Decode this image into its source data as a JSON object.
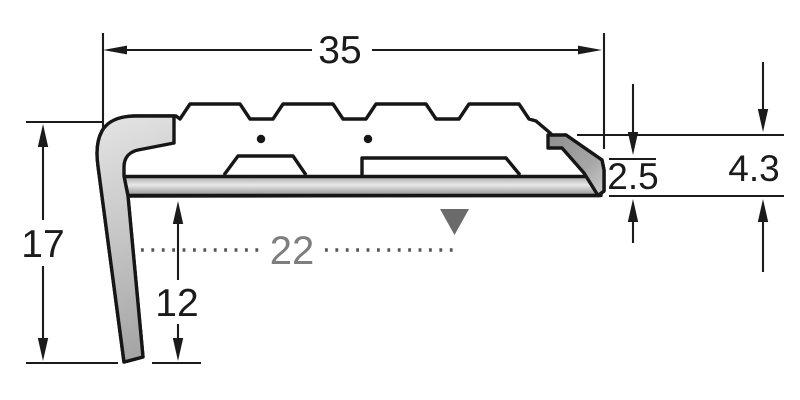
{
  "diagram": {
    "type": "technical-dimension-drawing",
    "subject": "stair-nosing-profile-cross-section",
    "dimensions": {
      "overall_width": "35",
      "front_height": "17",
      "tread_reference": "22",
      "leg_depth": "12",
      "back_height": "4.3",
      "edge_thickness": "2.5"
    },
    "colors": {
      "outline": "#161616",
      "dimension_line": "#1b1b1b",
      "dimension_text": "#1b1b1b",
      "secondary_gray": "#7e7e7e",
      "dot_gray": "#555555",
      "marker_gray": "#6b6b6b",
      "metal_light": "#ebebeb",
      "metal_mid": "#aaaaaa",
      "metal_dark": "#8c8c8c",
      "background": "#ffffff"
    }
  }
}
